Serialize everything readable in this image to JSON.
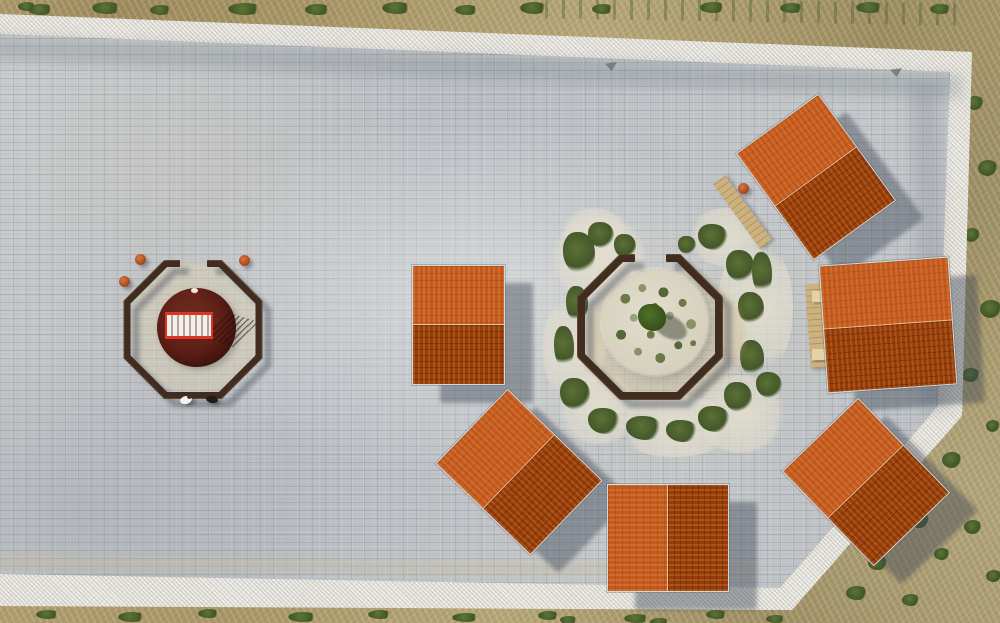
{
  "meta": {
    "type": "aerial-drone-photograph",
    "subject": "stone-paved plaza with six terracotta-roofed pavilions around an octagonal garden courtyard, a second octagonal courtyard with red circular platform, bordered by white rock walls and scrubland",
    "width_px": 1000,
    "height_px": 623
  },
  "palette": {
    "paving": "#bfc2c5",
    "wall": "#e8e6e0",
    "terrain": "#ab9868",
    "shrub": "#4c6330",
    "roof-light": "#d06c2c",
    "roof-light-stripe": "#c2591f",
    "roof-dark": "#b05416",
    "roof-dark-stripe": "#933d0c",
    "fence": "#412d1f",
    "red-disc": "#5f1f17",
    "railing": "#dd3524",
    "gravel": "#dcd6c5",
    "deck": "#cdb280",
    "shadow": "rgba(58,66,82,0.42)",
    "tree": "#3c5524"
  },
  "scene": {
    "pavilions": [
      {
        "name": "pavilion-north",
        "x": 765,
        "y": 111,
        "w": 102,
        "h": 132,
        "rot": -36
      },
      {
        "name": "pavilion-east",
        "x": 823,
        "y": 261,
        "w": 130,
        "h": 128,
        "rot": -4
      },
      {
        "name": "pavilion-southeast",
        "x": 813,
        "y": 416,
        "w": 106,
        "h": 132,
        "rot": -44
      },
      {
        "name": "pavilion-south",
        "x": 614,
        "y": 477,
        "w": 108,
        "h": 122,
        "rot": -90
      },
      {
        "name": "pavilion-southwest",
        "x": 467,
        "y": 406,
        "w": 104,
        "h": 132,
        "rot": -46
      },
      {
        "name": "pavilion-west",
        "x": 412,
        "y": 265,
        "w": 93,
        "h": 120,
        "rot": 0
      }
    ],
    "fences": [
      {
        "name": "garden-bench-ring",
        "cx": 650,
        "cy": 327,
        "apothem": 69,
        "len": 60,
        "th": 8,
        "stub": 15,
        "stubOffset": 23
      },
      {
        "name": "west-bench-ring",
        "cx": 193,
        "cy": 329,
        "apothem": 66,
        "len": 58,
        "th": 7,
        "stub": 15,
        "stubOffset": 21
      }
    ],
    "garden_gravel": [
      [
        552,
        212,
        95,
        95
      ],
      [
        543,
        290,
        62,
        115
      ],
      [
        556,
        372,
        85,
        72
      ],
      [
        612,
        395,
        125,
        62
      ],
      [
        693,
        375,
        95,
        78
      ],
      [
        718,
        235,
        75,
        145
      ],
      [
        685,
        208,
        85,
        58
      ],
      [
        558,
        208,
        72,
        58
      ]
    ],
    "garden_green": [
      [
        563,
        232,
        32,
        42
      ],
      [
        588,
        222,
        26,
        26
      ],
      [
        566,
        286,
        22,
        36
      ],
      [
        554,
        326,
        20,
        42
      ],
      [
        560,
        378,
        30,
        32
      ],
      [
        588,
        408,
        32,
        26
      ],
      [
        626,
        416,
        36,
        24
      ],
      [
        666,
        420,
        32,
        22
      ],
      [
        698,
        406,
        32,
        26
      ],
      [
        724,
        382,
        28,
        30
      ],
      [
        740,
        340,
        24,
        36
      ],
      [
        738,
        292,
        26,
        32
      ],
      [
        726,
        250,
        28,
        32
      ],
      [
        698,
        224,
        30,
        26
      ],
      [
        614,
        234,
        22,
        24
      ],
      [
        752,
        252,
        20,
        42
      ],
      [
        756,
        372,
        26,
        26
      ],
      [
        678,
        236,
        18,
        18
      ]
    ],
    "bushes": [
      [
        28,
        4,
        26,
        11
      ],
      [
        92,
        2,
        30,
        12
      ],
      [
        150,
        5,
        22,
        10
      ],
      [
        228,
        3,
        34,
        12
      ],
      [
        305,
        4,
        26,
        11
      ],
      [
        382,
        2,
        30,
        12
      ],
      [
        455,
        5,
        24,
        10
      ],
      [
        520,
        2,
        28,
        12
      ],
      [
        592,
        4,
        22,
        10
      ],
      [
        700,
        2,
        26,
        11
      ],
      [
        780,
        3,
        24,
        10
      ],
      [
        856,
        2,
        28,
        11
      ],
      [
        930,
        4,
        22,
        10
      ],
      [
        18,
        2,
        18,
        9
      ],
      [
        966,
        96,
        18,
        14
      ],
      [
        978,
        160,
        20,
        16
      ],
      [
        964,
        228,
        16,
        14
      ],
      [
        980,
        300,
        22,
        18
      ],
      [
        962,
        368,
        18,
        14
      ],
      [
        942,
        452,
        20,
        16
      ],
      [
        908,
        512,
        22,
        16
      ],
      [
        868,
        556,
        20,
        14
      ],
      [
        986,
        420,
        14,
        12
      ],
      [
        934,
        548,
        16,
        12
      ],
      [
        846,
        586,
        22,
        14
      ],
      [
        902,
        594,
        18,
        12
      ],
      [
        964,
        520,
        18,
        14
      ],
      [
        986,
        570,
        16,
        12
      ],
      [
        36,
        610,
        24,
        9
      ],
      [
        118,
        612,
        28,
        10
      ],
      [
        198,
        609,
        22,
        9
      ],
      [
        288,
        612,
        30,
        10
      ],
      [
        368,
        610,
        24,
        9
      ],
      [
        452,
        613,
        28,
        9
      ],
      [
        538,
        611,
        22,
        9
      ],
      [
        624,
        614,
        26,
        9
      ],
      [
        706,
        610,
        22,
        9
      ],
      [
        766,
        615,
        20,
        8
      ],
      [
        560,
        616,
        18,
        8
      ],
      [
        650,
        618,
        20,
        8
      ]
    ],
    "objects": {
      "person_count": 1,
      "dog_count": 1,
      "barrel_planters": [
        [
          135,
          254
        ],
        [
          119,
          276
        ],
        [
          239,
          255
        ]
      ],
      "center_tree": 1,
      "red_platform": "circular dark-red platform with red railing frame"
    }
  }
}
